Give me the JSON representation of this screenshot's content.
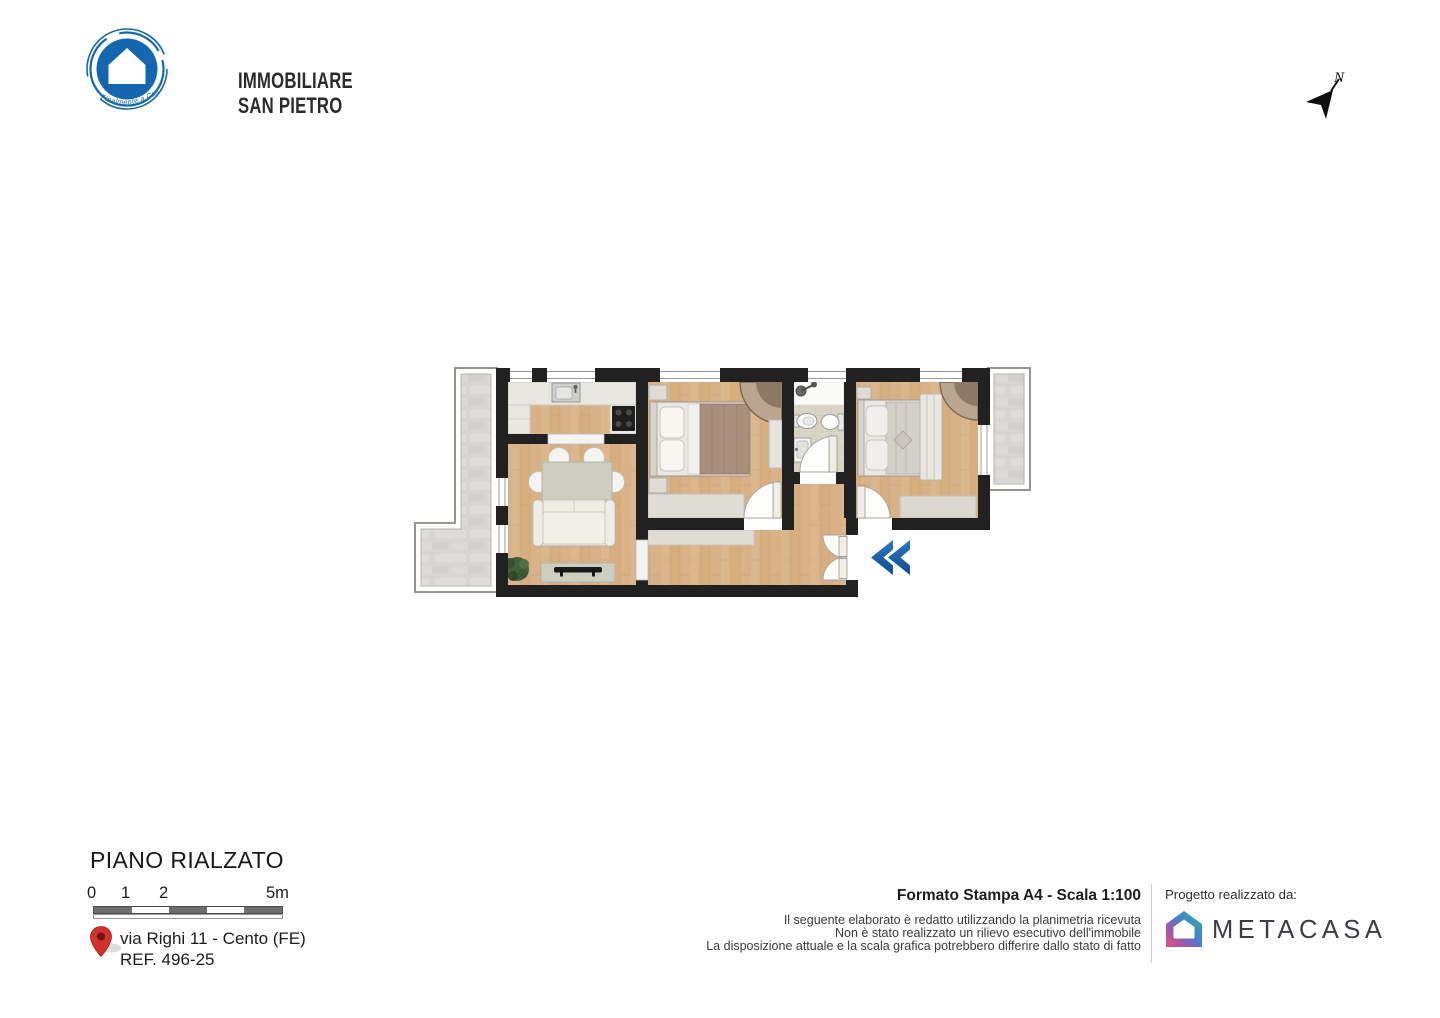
{
  "brand": {
    "line1": "IMMOBILIARE",
    "line2": "SAN PIETRO",
    "tagline": "Finalmente a Casa"
  },
  "compass": {
    "label": "N"
  },
  "plan_info": {
    "floor_title": "PIANO RIALZATO",
    "scale_labels": [
      "0",
      "1",
      "2",
      "5m"
    ],
    "address": "via Righi 11 - Cento (FE)",
    "reference": "REF. 496-25"
  },
  "print_info": {
    "title": "Formato Stampa A4 - Scala 1:100",
    "disclaimer_lines": [
      "Il seguente elaborato è redatto utilizzando la planimetria ricevuta",
      "Non è stato realizzato un rilievo esecutivo dell'immobile",
      "La disposizione attuale e la scala grafica potrebbero differire dallo stato di fatto"
    ]
  },
  "credits": {
    "label": "Progetto realizzato da:",
    "company": "METACASA"
  },
  "colors": {
    "brand_blue": "#1467AE",
    "entrance_arrow_blue": "#1B65AE",
    "pin_red": "#D2302C",
    "wall": "#212121",
    "wood_floor": "#DCB78D"
  }
}
